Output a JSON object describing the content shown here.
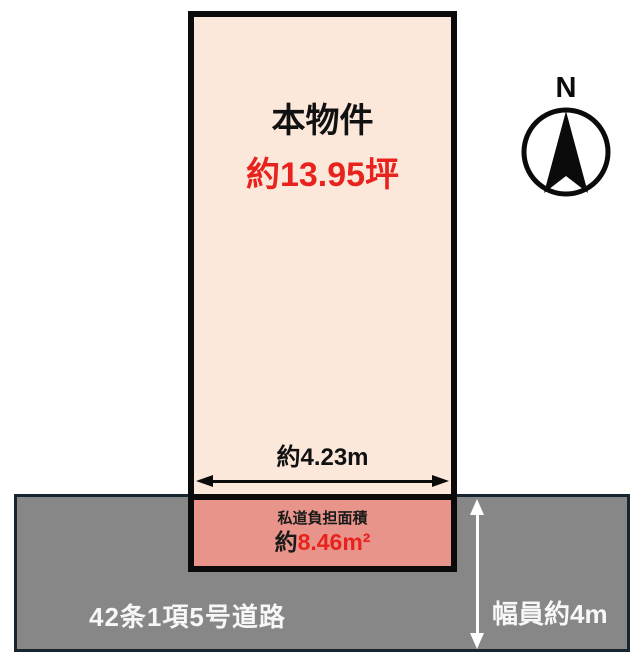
{
  "diagram": {
    "property": {
      "name_label": "本物件",
      "area_label": "約13.95坪",
      "frontage_label": "約4.23m"
    },
    "private_road": {
      "title": "私道負担面積",
      "area_prefix": "約",
      "area_value": "8.46m²"
    },
    "road": {
      "name_label": "42条1項5号道路",
      "width_label": "幅員約4m"
    },
    "compass": {
      "north_label": "N"
    },
    "colors": {
      "property_fill": "#fce8da",
      "private_road_fill": "#e8948b",
      "road_fill": "#878787",
      "road_border": "#17262e",
      "road_text": "#f7f7f7",
      "outline": "#0b0b0b",
      "accent_red": "#e8231d"
    }
  }
}
